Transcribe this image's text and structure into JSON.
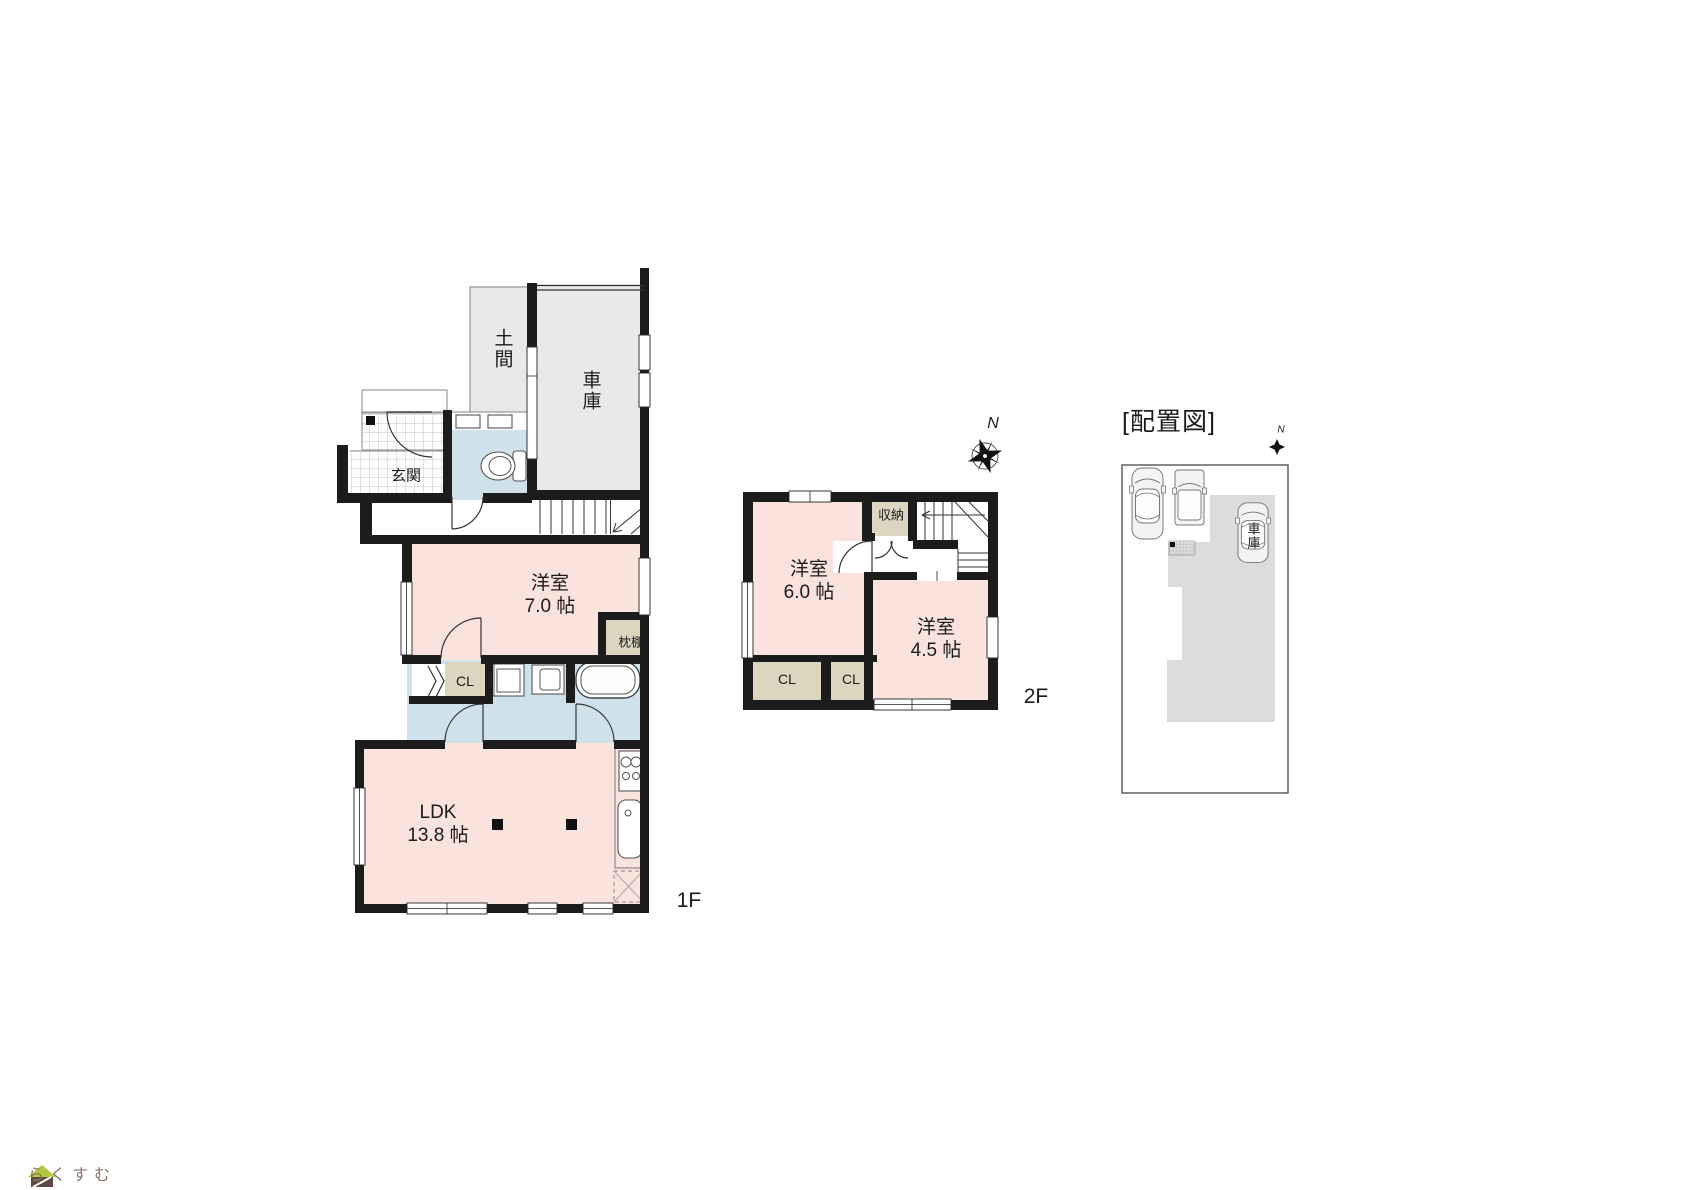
{
  "floor1": {
    "floor_label": "1F",
    "doma": "土間",
    "garage": "車庫",
    "genkan": "玄関",
    "western_room": {
      "label": "洋室",
      "size": "7.0 帖"
    },
    "pillow_shelf": "枕棚",
    "closet": "CL",
    "ldk": {
      "label": "LDK",
      "size": "13.8 帖"
    }
  },
  "floor2": {
    "floor_label": "2F",
    "compass": "N",
    "western_room_6": {
      "label": "洋室",
      "size": "6.0 帖"
    },
    "western_room_45": {
      "label": "洋室",
      "size": "4.5 帖"
    },
    "storage": "収納",
    "closet_left": "CL",
    "closet_right": "CL"
  },
  "site_plan": {
    "title": "[配置図]",
    "compass": "N",
    "garage": "車庫"
  },
  "logo": {
    "text": "らくすむ"
  },
  "colors": {
    "wall": "#1c1c1c",
    "room_pink": "#fae3dc",
    "wet_blue": "#cfe1eb",
    "closet_beige": "#dcd5c0",
    "garage_gray": "#e9e9e9",
    "site_gray": "#dcdcdc",
    "logo_brown": "#8a7568"
  }
}
